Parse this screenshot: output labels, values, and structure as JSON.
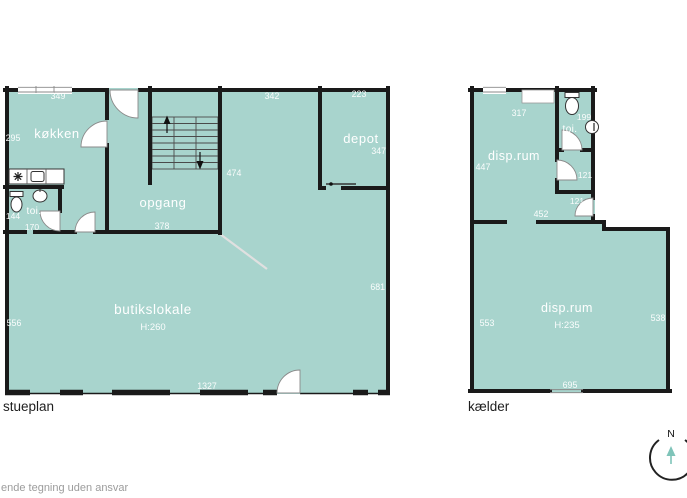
{
  "colors": {
    "room_fill": "#a8d4cd",
    "wall": "#1a1a1a",
    "room_text": "#ffffff",
    "plan_label_text": "#1e1e1e",
    "disclaimer_text": "#9c9c9c",
    "compass_arrow": "#7fc4b9"
  },
  "plans": {
    "stueplan": {
      "label": "stueplan",
      "rooms": {
        "kokken": {
          "name": "køkken"
        },
        "toilet": {
          "name": "toi."
        },
        "opgang": {
          "name": "opgang"
        },
        "depot": {
          "name": "depot"
        },
        "butikslokale": {
          "name": "butikslokale",
          "ceiling_height": "H:260"
        }
      },
      "measurements": {
        "kokken_width": "349",
        "kokken_depth": "295",
        "entry_width": "139",
        "shop_top_width": "342",
        "depot_width": "223",
        "shop_top_depth": "474",
        "depot_depth": "347",
        "toilet_depth": "144",
        "toilet_width": "170",
        "opgang_width": "378",
        "shop_left_depth": "556",
        "shop_right_depth": "681",
        "shop_width": "1327"
      }
    },
    "kaelder": {
      "label": "kælder",
      "rooms": {
        "disp_rum_upper": {
          "name": "disp.rum"
        },
        "toilet": {
          "name": "toi."
        },
        "disp_rum_lower": {
          "name": "disp.rum",
          "ceiling_height": "H:235"
        }
      },
      "measurements": {
        "disp_upper_width": "317",
        "disp_upper_depth": "447",
        "toilet_depth": "199",
        "small_room_depth": "121",
        "hall_depth": "121",
        "hall_width": "452",
        "disp_lower_left_depth": "553",
        "disp_lower_right_depth": "538",
        "disp_lower_width": "695"
      }
    }
  },
  "compass": {
    "north_label": "N"
  },
  "footer": {
    "disclaimer": "ende tegning uden ansvar"
  }
}
